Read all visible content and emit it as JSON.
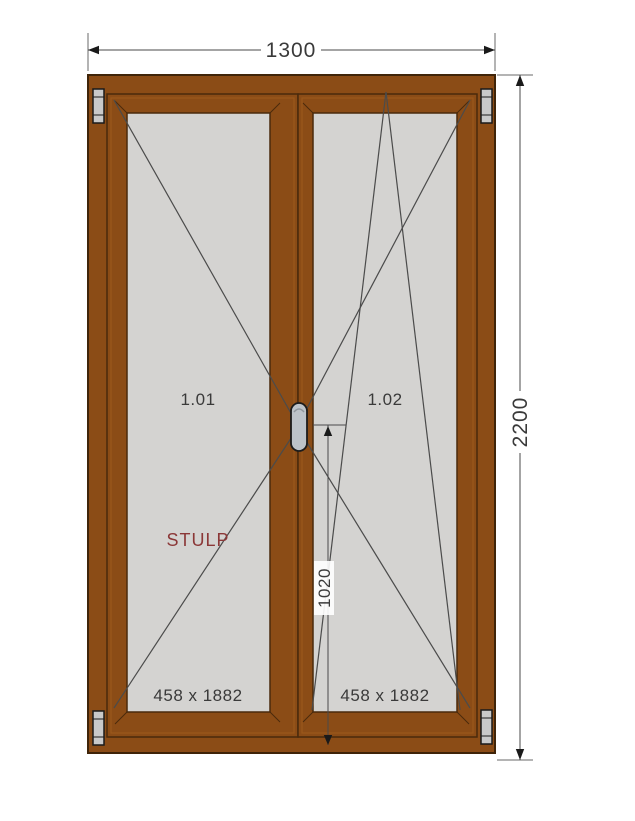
{
  "drawing": {
    "type": "window-technical-drawing",
    "dimensions": {
      "total_width": "1300",
      "total_height": "2200",
      "handle_height": "1020"
    },
    "panes": [
      {
        "id": "1.01",
        "size": "458 x 1882",
        "opening_symbol": "turn, hinged left"
      },
      {
        "id": "1.02",
        "size": "458 x 1882",
        "opening_symbol": "tilt-and-turn, hinged right"
      }
    ],
    "stulp_label": "STULP",
    "colors": {
      "frame": "#8B4C16",
      "frame_dark": "#3F2409",
      "frame_light": "#9D5A1C",
      "glass": "#D4D3D1",
      "dimension_text": "#3A3A3A",
      "stulp_text": "#8B3737",
      "hinge_fill": "#C9C9C9",
      "handle_fill": "#BDC3C9",
      "background": "#FFFFFF"
    }
  }
}
